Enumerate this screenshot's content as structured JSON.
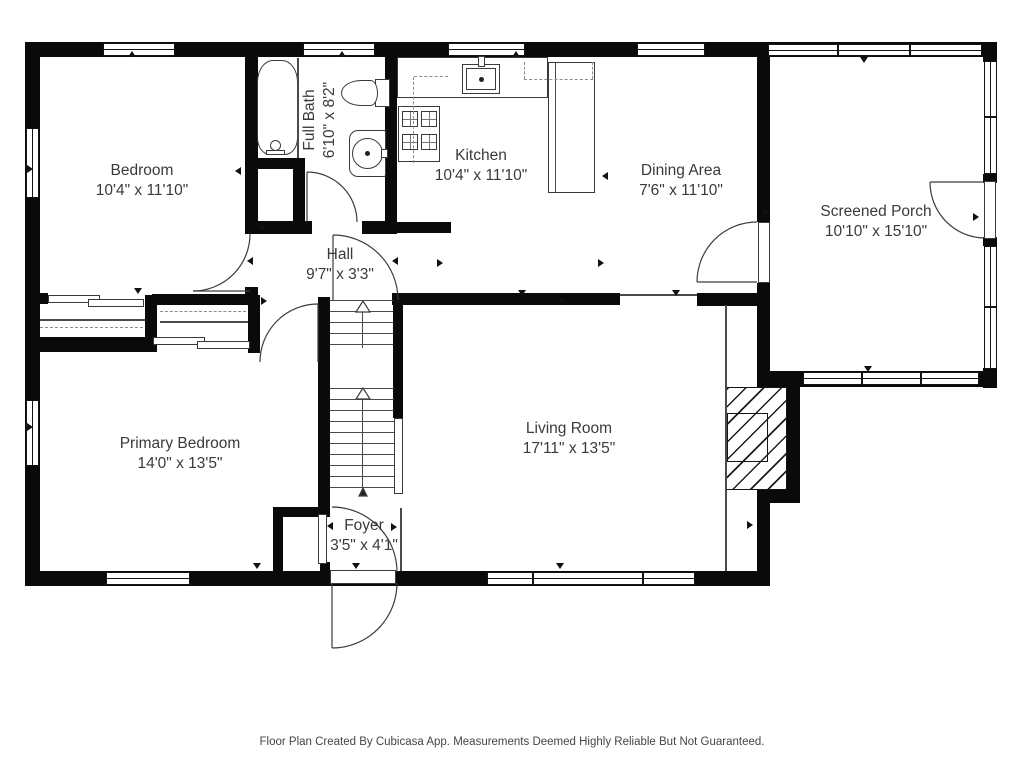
{
  "plan": {
    "rooms": [
      {
        "id": "bedroom",
        "name": "Bedroom",
        "dims": "10'4\" x 11'10\""
      },
      {
        "id": "full_bath",
        "name": "Full Bath",
        "dims": "6'10\" x 8'2\""
      },
      {
        "id": "kitchen",
        "name": "Kitchen",
        "dims": "10'4\" x 11'10\""
      },
      {
        "id": "dining_area",
        "name": "Dining Area",
        "dims": "7'6\" x 11'10\""
      },
      {
        "id": "screened_porch",
        "name": "Screened Porch",
        "dims": "10'10\" x 15'10\""
      },
      {
        "id": "hall",
        "name": "Hall",
        "dims": "9'7\" x 3'3\""
      },
      {
        "id": "primary_bedroom",
        "name": "Primary Bedroom",
        "dims": "14'0\" x 13'5\""
      },
      {
        "id": "living_room",
        "name": "Living Room",
        "dims": "17'11\" x 13'5\""
      },
      {
        "id": "foyer",
        "name": "Foyer",
        "dims": "3'5\" x 4'1\""
      }
    ],
    "fixtures": [
      "bathtub",
      "toilet",
      "bathroom-sink",
      "kitchen-sink",
      "stove",
      "counter",
      "peninsula-counter",
      "fireplace",
      "staircase",
      "sliding-door-closets",
      "front-door"
    ],
    "colors": {
      "wall": "#0a0a0a",
      "label": "#3a3a3a",
      "background": "#ffffff"
    },
    "footer": "Floor Plan Created By Cubicasa App. Measurements Deemed Highly Reliable But Not Guaranteed."
  }
}
